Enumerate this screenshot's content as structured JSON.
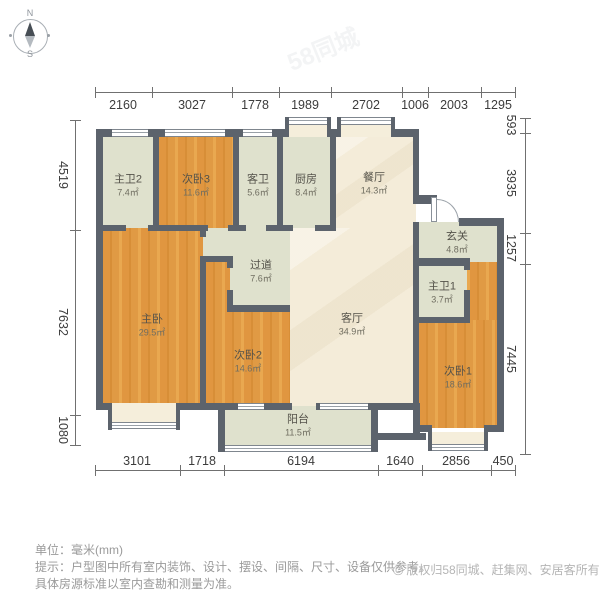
{
  "compass": {
    "north": "N",
    "south": "S"
  },
  "watermark": "58同城",
  "rooms": [
    {
      "name": "主卫2",
      "area": "7.4㎡"
    },
    {
      "name": "次卧3",
      "area": "11.6㎡"
    },
    {
      "name": "客卫",
      "area": "5.6㎡"
    },
    {
      "name": "厨房",
      "area": "8.4㎡"
    },
    {
      "name": "餐厅",
      "area": "14.3㎡"
    },
    {
      "name": "玄关",
      "area": "4.8㎡"
    },
    {
      "name": "过道",
      "area": "7.6㎡"
    },
    {
      "name": "主卧",
      "area": "29.5㎡"
    },
    {
      "name": "次卧2",
      "area": "14.6㎡"
    },
    {
      "name": "客厅",
      "area": "34.9㎡"
    },
    {
      "name": "主卫1",
      "area": "3.7㎡"
    },
    {
      "name": "次卧1",
      "area": "18.6㎡"
    },
    {
      "name": "阳台",
      "area": "11.5㎡"
    }
  ],
  "dimensions": {
    "top": [
      "2160",
      "3027",
      "1778",
      "1989",
      "2702",
      "1006",
      "2003",
      "1295"
    ],
    "bottom": [
      "3101",
      "1718",
      "6194",
      "1640",
      "2856",
      "450"
    ],
    "left": [
      "4519",
      "7632",
      "1080"
    ],
    "right": [
      "593",
      "3935",
      "1257",
      "7445"
    ]
  },
  "footer": {
    "unit": "单位：毫米(mm)",
    "tip": "提示：户型图中所有室内装饰、设计、摆设、间隔、尺寸、设备仅供参考。",
    "tip2": "具体房源标准以室内查勘和测量为准。",
    "copyright_mark": "©",
    "copyright": "版权归58同城、赶集网、安居客所有"
  },
  "colors": {
    "wall": "#5c636c",
    "wood": "#e19a43",
    "tile": "#dfe1cd",
    "cream": "#f4ecd9"
  }
}
